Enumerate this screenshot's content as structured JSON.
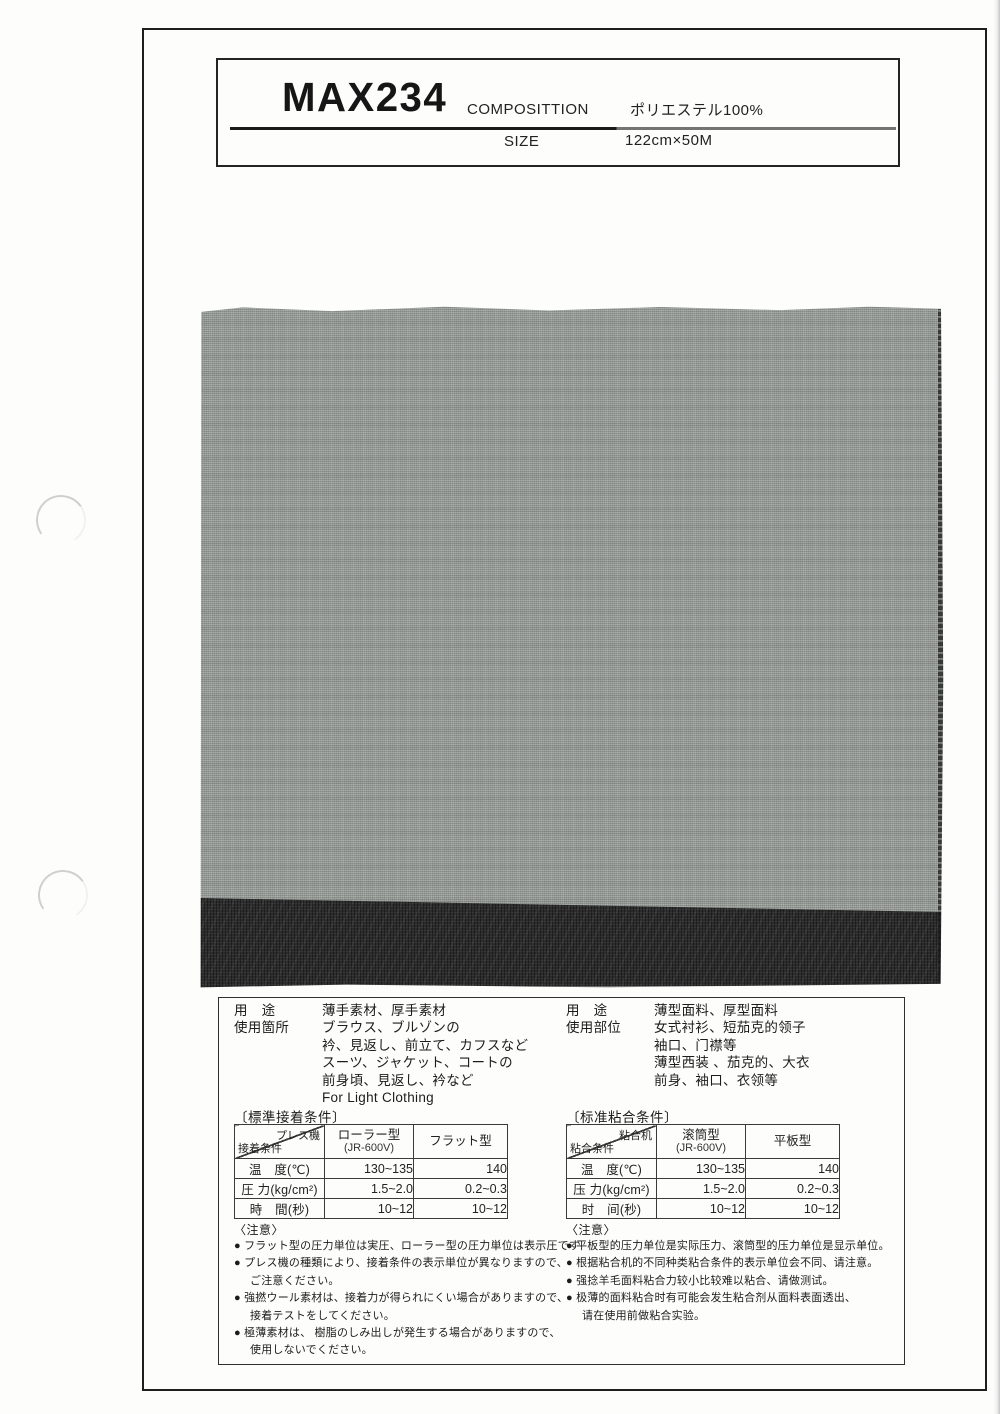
{
  "header": {
    "product_code": "MAX234",
    "composition_label": "COMPOSITTION",
    "composition_value": "ポリエステル100%",
    "size_label": "SIZE",
    "size_value": "122cm×50M"
  },
  "swatch": {
    "gray_color": "#a8ada9",
    "dark_strip_color": "#2c2c2d"
  },
  "left": {
    "usage_rows": [
      {
        "label": "用　途",
        "text": "薄手素材、厚手素材"
      },
      {
        "label": "使用箇所",
        "text": "ブラウス、ブルゾンの"
      },
      {
        "label": "",
        "text": "衿、見返し、前立て、カフスなど"
      },
      {
        "label": "",
        "text": "スーツ、ジャケット、コートの"
      },
      {
        "label": "",
        "text": "前身頃、見返し、衿など"
      },
      {
        "label": "",
        "text": "For Light Clothing"
      }
    ],
    "table_title": "〔標準接着条件〕",
    "table": {
      "corner_top": "プレス機",
      "corner_bottom": "接着条件",
      "col1_title": "ローラー型",
      "col1_sub": "(JR-600V)",
      "col2_title": "フラット型",
      "rows": [
        {
          "label": "温　度(℃)",
          "v1": "130~135",
          "v2": "140"
        },
        {
          "label": "圧 力(kg/cm²)",
          "v1": "1.5~2.0",
          "v2": "0.2~0.3"
        },
        {
          "label": "時　間(秒)",
          "v1": "10~12",
          "v2": "10~12"
        }
      ]
    },
    "notes_title": "〈注意〉",
    "notes": [
      {
        "text": "● フラット型の圧力単位は実圧、ローラー型の圧力単位は表示圧です"
      },
      {
        "text": "● プレス機の種類により、接着条件の表示単位が異なりますので、"
      },
      {
        "text": "ご注意ください。"
      },
      {
        "text": "● 強撚ウール素材は、接着力が得られにくい場合がありますので、"
      },
      {
        "text": "接着テストをしてください。"
      },
      {
        "text": "● 極薄素材は、 樹脂のしみ出しが発生する場合がありますので、"
      },
      {
        "text": "使用しないでください。"
      }
    ]
  },
  "right": {
    "usage_rows": [
      {
        "label": "用　途",
        "text": "薄型面料、厚型面料"
      },
      {
        "label": "使用部位",
        "text": "女式衬衫、短茄克的领子"
      },
      {
        "label": "",
        "text": "袖口、门襟等"
      },
      {
        "label": "",
        "text": "薄型西装 、茄克的、大衣"
      },
      {
        "label": "",
        "text": "前身、袖口、衣领等"
      }
    ],
    "table_title": "〔标准粘合条件〕",
    "table": {
      "corner_top": "粘合机",
      "corner_bottom": "粘合条件",
      "col1_title": "滚筒型",
      "col1_sub": "(JR-600V)",
      "col2_title": "平板型",
      "rows": [
        {
          "label": "温　度(℃)",
          "v1": "130~135",
          "v2": "140"
        },
        {
          "label": "压 力(kg/cm²)",
          "v1": "1.5~2.0",
          "v2": "0.2~0.3"
        },
        {
          "label": "时　间(秒)",
          "v1": "10~12",
          "v2": "10~12"
        }
      ]
    },
    "notes_title": "〈注意〉",
    "notes": [
      {
        "text": "● 平板型的压力单位是实际压力、滚筒型的压力单位是显示单位。"
      },
      {
        "text": "● 根据粘合机的不同种类粘合条件的表示单位会不同、请注意。"
      },
      {
        "text": "● 强捻羊毛面料粘合力较小比较难以粘合、请做测试。"
      },
      {
        "text": "● 极薄的面料粘合时有可能会发生粘合剂从面料表面透出、"
      },
      {
        "text": "请在使用前做粘合实验。"
      }
    ]
  }
}
